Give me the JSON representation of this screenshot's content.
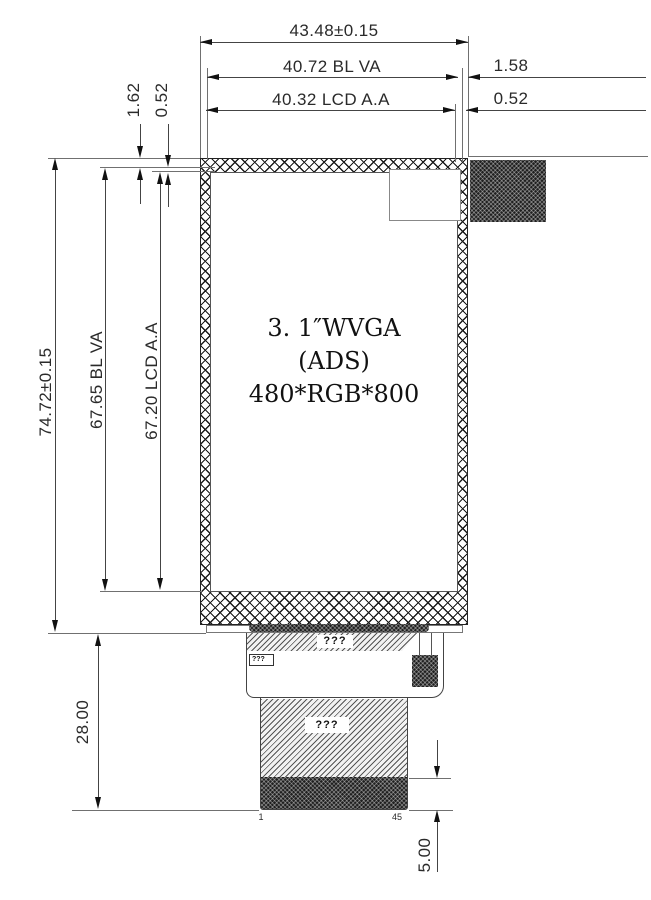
{
  "dims": {
    "width_overall": "43.48±0.15",
    "width_bl_va": "40.72 BL VA",
    "width_lcd_aa": "40.32 LCD A.A",
    "right_margin_bl": "1.58",
    "right_margin_lcd": "0.52",
    "top_margin_bl": "1.62",
    "top_margin_lcd": "0.52",
    "height_overall": "74.72±0.15",
    "height_bl_va": "67.65 BL VA",
    "height_lcd_aa": "67.20 LCD A.A",
    "fpc_length": "28.00",
    "contact_depth": "5.00"
  },
  "panel": {
    "line1": "3. 1″WVGA",
    "line2": "(ADS)",
    "line3": "480*RGB*800"
  },
  "fpc": {
    "stiffener_label": "???",
    "component_label": "???",
    "tail_label": "???",
    "pin_first": "1",
    "pin_last": "45"
  },
  "colors": {
    "line": "#444444",
    "extension_line": "#707070",
    "text": "#2a2a2a",
    "dark_fill": "#1f1f1f",
    "background": "#ffffff"
  }
}
